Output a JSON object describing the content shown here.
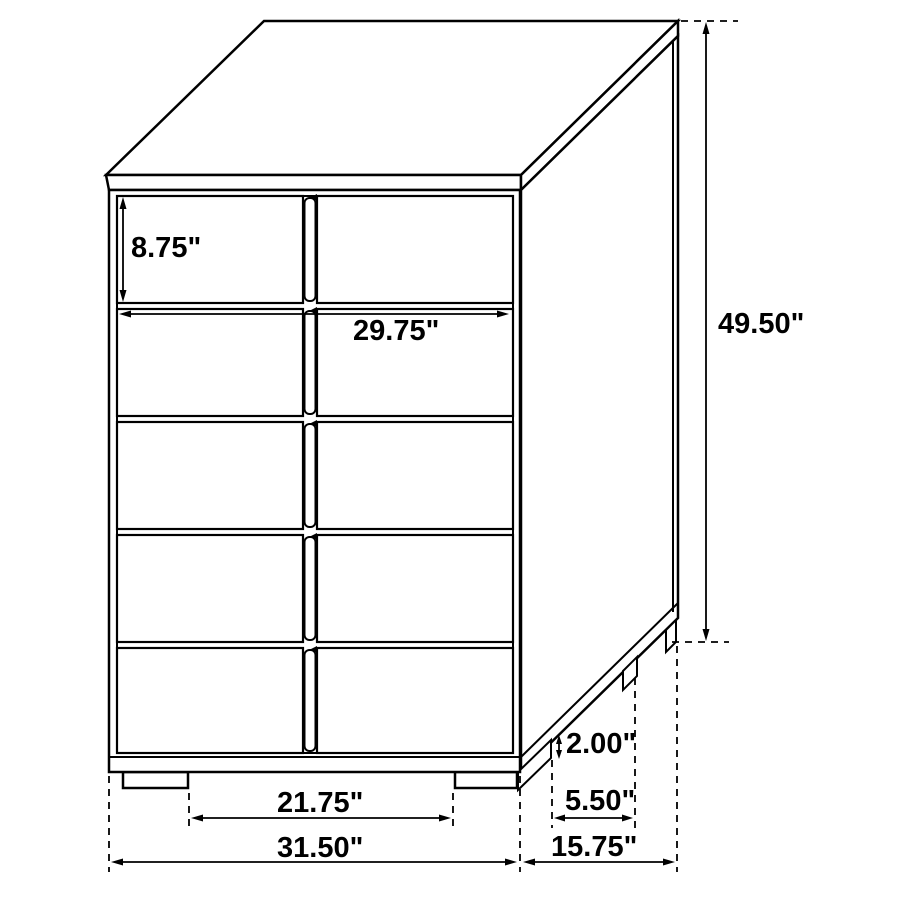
{
  "diagram": {
    "item": "5-drawer chest",
    "view": "isometric front-right line drawing",
    "units": "inches",
    "colors": {
      "line": "#000000",
      "background": "#ffffff",
      "text": "#000000"
    },
    "furniture": {
      "drawer_rows": 5,
      "drawer_columns": 2,
      "front_feet": 2,
      "side_feet": 3
    },
    "dimensions": {
      "top_drawer_height": "8.75\"",
      "drawer_front_width": "29.75\"",
      "overall_height": "49.50\"",
      "foot_height": "2.00\"",
      "side_foot_spacing": "5.50\"",
      "front_foot_spacing": "21.75\"",
      "overall_width": "31.50\"",
      "overall_depth": "15.75\""
    }
  }
}
